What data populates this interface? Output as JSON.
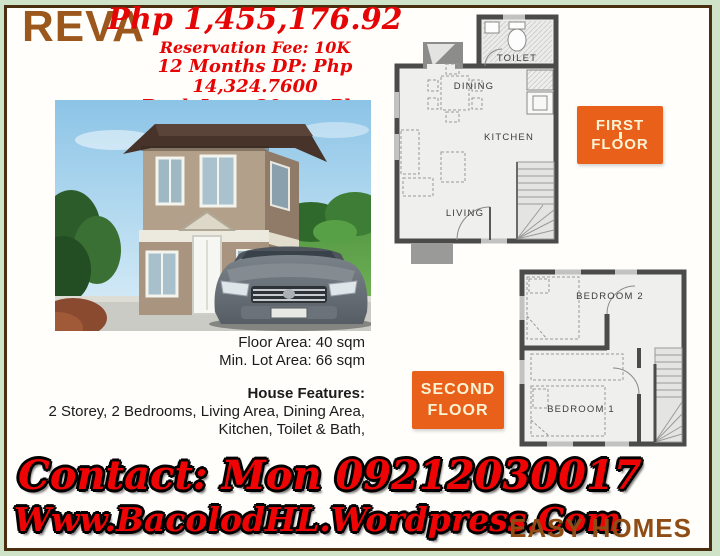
{
  "header": {
    "model": "REVA"
  },
  "pricing": {
    "price": "Php 1,455,176.92",
    "reservation": "Reservation Fee: 10K",
    "dp": "12 Months DP: Php 14,324.7600",
    "loan": "Bank Loan 20yrs.: Php 10,650.22"
  },
  "specs": {
    "floor_area": "Floor Area: 40 sqm",
    "lot_area": "Min. Lot Area: 66 sqm",
    "features_title": "House Features:",
    "features_line1": "2 Storey, 2 Bedrooms, Living Area, Dining Area,",
    "features_line2": "Kitchen, Toilet & Bath,"
  },
  "plans": {
    "first": {
      "badge_line1": "FIRST",
      "badge_line2": "FLOOR",
      "rooms": {
        "toilet": "TOILET",
        "dining": "DINING",
        "kitchen": "KITCHEN",
        "living": "LIVING"
      }
    },
    "second": {
      "badge_line1": "SECOND",
      "badge_line2": "FLOOR",
      "rooms": {
        "bedroom2": "BEDROOM 2",
        "bedroom1": "BEDROOM 1"
      }
    }
  },
  "contact": {
    "line1": "Contact: Mon 09212030017",
    "line2": "Www.BacolodHL.Wordpress.Com"
  },
  "brand": {
    "name": "EASY HOMES"
  },
  "colors": {
    "brand_brown": "#9b571c",
    "price_red": "#e60505",
    "badge_orange": "#e8601a",
    "frame_brown": "#4a2e10",
    "outer_green": "#cfe3c8"
  }
}
